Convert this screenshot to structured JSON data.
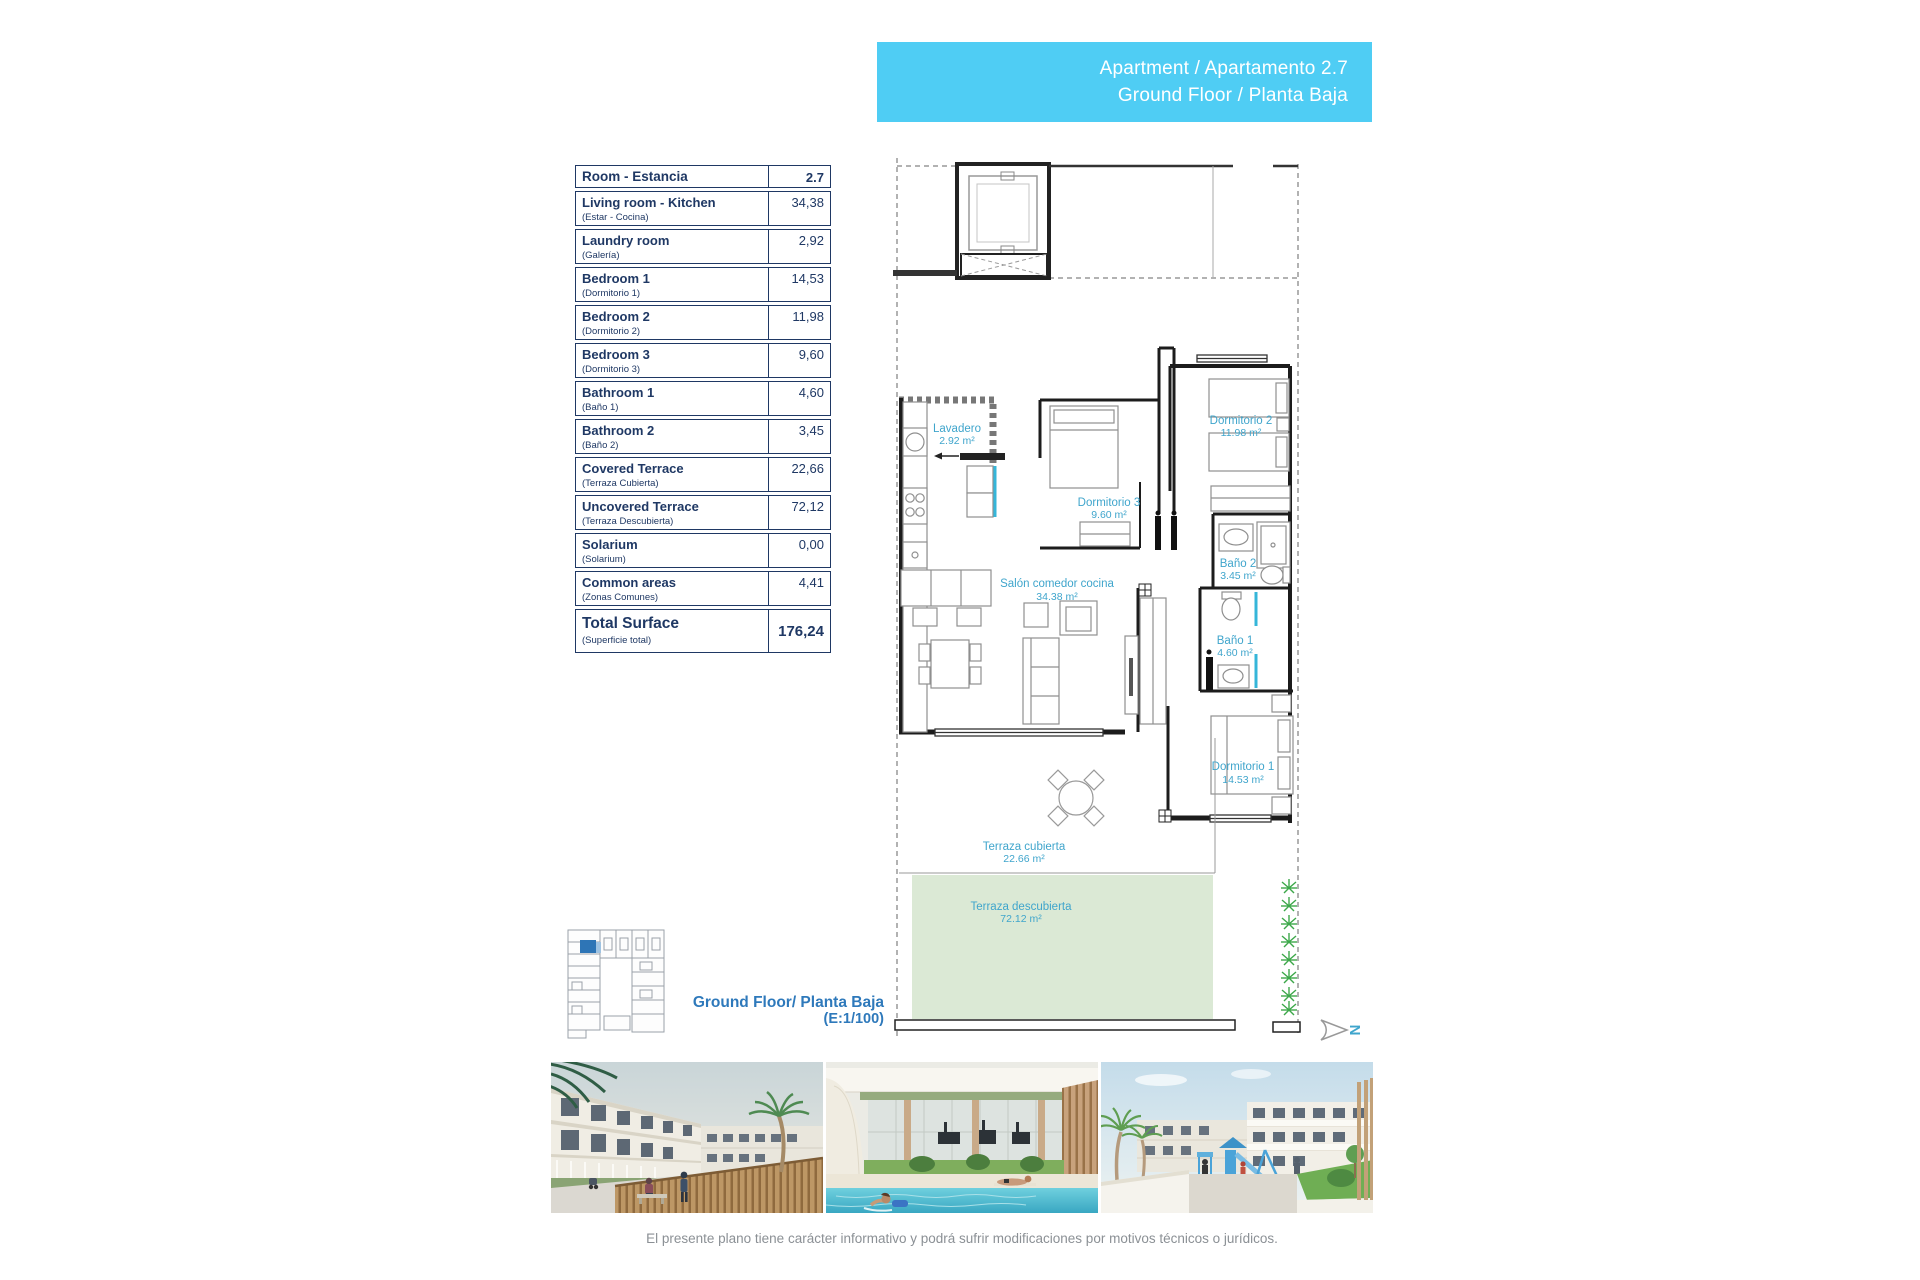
{
  "banner": {
    "line1": "Apartment / Apartamento 2.7",
    "line2": "Ground Floor / Planta Baja"
  },
  "surface_table": {
    "header": {
      "label": "Room - Estancia",
      "value": "2.7"
    },
    "rows": [
      {
        "en": "Living room - Kitchen",
        "es": "(Estar - Cocina)",
        "value": "34,38"
      },
      {
        "en": "Laundry room",
        "es": "(Galería)",
        "value": "2,92"
      },
      {
        "en": "Bedroom 1",
        "es": "(Dormitorio 1)",
        "value": "14,53"
      },
      {
        "en": "Bedroom 2",
        "es": "(Dormitorio 2)",
        "value": "11,98"
      },
      {
        "en": "Bedroom 3",
        "es": "(Dormitorio 3)",
        "value": "9,60"
      },
      {
        "en": "Bathroom 1",
        "es": "(Baño 1)",
        "value": "4,60"
      },
      {
        "en": "Bathroom 2",
        "es": "(Baño 2)",
        "value": "3,45"
      },
      {
        "en": "Covered Terrace",
        "es": "(Terraza Cubierta)",
        "value": "22,66"
      },
      {
        "en": "Uncovered Terrace",
        "es": "(Terraza Descubierta)",
        "value": "72,12"
      },
      {
        "en": "Solarium",
        "es": "(Solarium)",
        "value": "0,00"
      },
      {
        "en": "Common areas",
        "es": "(Zonas Comunes)",
        "value": "4,41"
      }
    ],
    "total": {
      "en": "Total Surface",
      "es": "(Superficie total)",
      "value": "176,24"
    }
  },
  "plan": {
    "rooms": {
      "lavadero": {
        "name": "Lavadero",
        "area": "2.92 m²"
      },
      "dormitorio3": {
        "name": "Dormitorio 3",
        "area": "9.60 m²"
      },
      "dormitorio2": {
        "name": "Dormitorio 2",
        "area": "11.98 m²"
      },
      "bano2": {
        "name": "Baño 2",
        "area": "3.45 m²"
      },
      "salon": {
        "name": "Salón comedor cocina",
        "area": "34.38 m²"
      },
      "bano1": {
        "name": "Baño 1",
        "area": "4.60 m²"
      },
      "dormitorio1": {
        "name": "Dormitorio 1",
        "area": "14.53 m²"
      },
      "terraza_cubierta": {
        "name": "Terraza cubierta",
        "area": "22.66 m²"
      },
      "terraza_descubierta": {
        "name": "Terraza descubierta",
        "area": "72.12 m²"
      }
    },
    "north_letter": "N"
  },
  "floor_label": {
    "line1": "Ground Floor/ Planta Baja",
    "line2": "(E:1/100)"
  },
  "disclaimer": "El presente plano tiene carácter informativo y podrá sufrir modificaciones por motivos técnicos o jurídicos.",
  "colors": {
    "banner": "#4fcdf4",
    "navy": "#1f3864",
    "label_blue": "#3fa5cc",
    "heading_blue": "#2e79bb",
    "terrace_green": "#dbe9d5",
    "plant_green": "#3da84a",
    "map_blue": "#2e75b6",
    "cyan": "#35b6d9",
    "disclaimer_gray": "#8b9095"
  }
}
